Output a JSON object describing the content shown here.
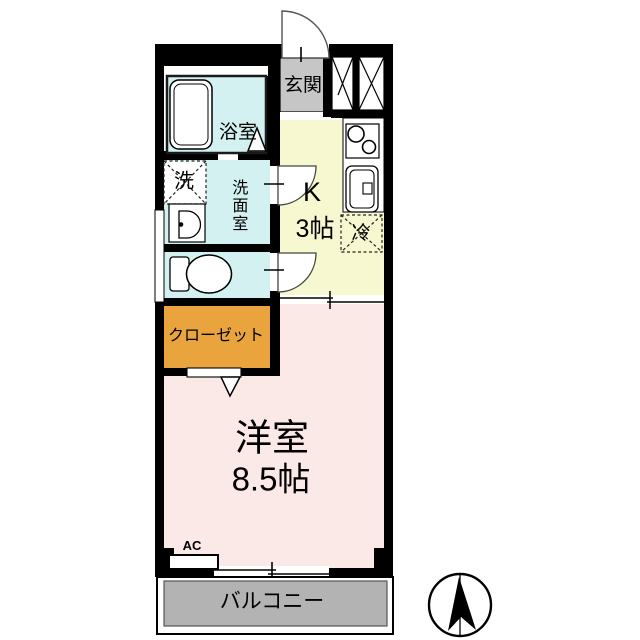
{
  "floorplan": {
    "labels": {
      "genkan": "玄関",
      "bathroom": "浴室",
      "laundry": "洗",
      "washroom": "洗面室",
      "kitchen_type": "K",
      "kitchen_size": "3帖",
      "fridge": "冷",
      "closet": "クローゼット",
      "main_room_type": "洋室",
      "main_room_size": "8.5帖",
      "ac": "AC",
      "balcony": "バルコニー"
    },
    "colors": {
      "wall": "#000000",
      "genkan_floor": "#c6c6c6",
      "wet_area": "#d4f1f1",
      "kitchen": "#f8f8d0",
      "closet": "#e9a43e",
      "main_room": "#fbe9e7",
      "balcony": "#b3b3b3"
    }
  }
}
